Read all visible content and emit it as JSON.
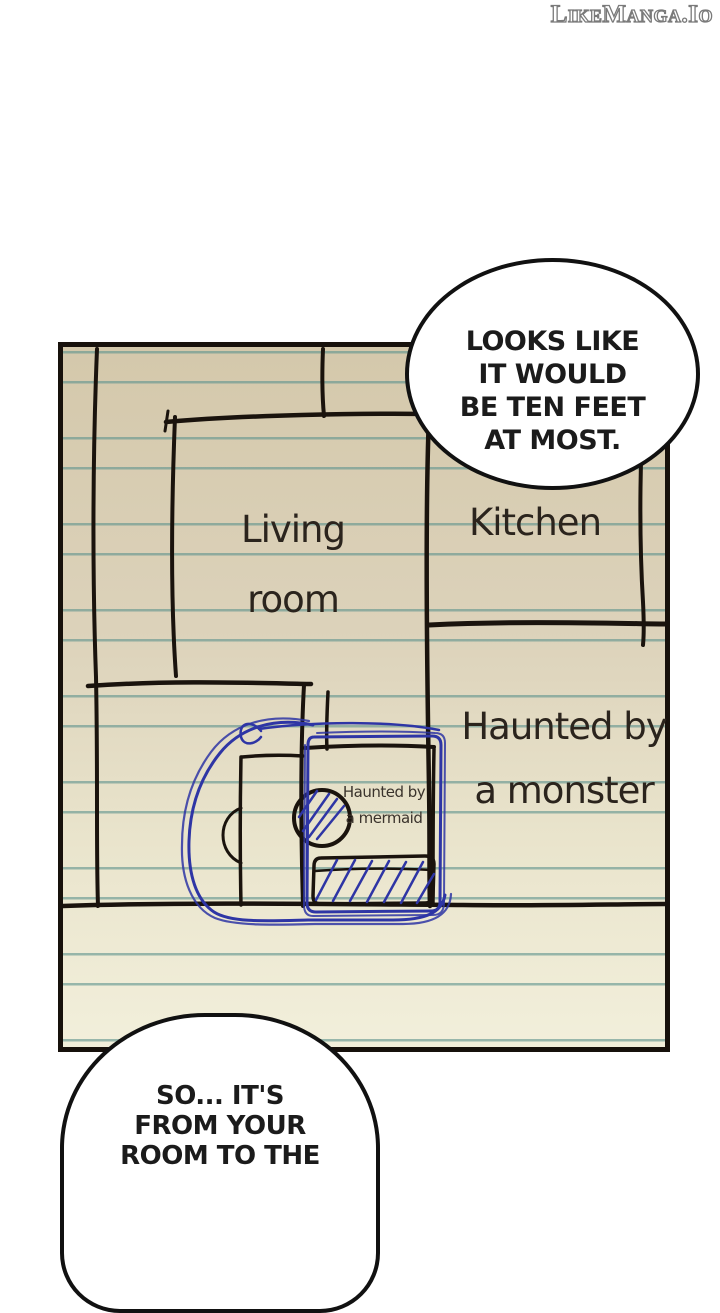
{
  "watermark": {
    "text": "LikeManga.Io"
  },
  "speech_bubbles": {
    "top": {
      "lines": [
        "LOOKS LIKE",
        "IT WOULD",
        "BE TEN FEET",
        "AT MOST."
      ]
    },
    "bottom": {
      "lines": [
        "SO... IT'S",
        "FROM YOUR",
        "ROOM TO THE"
      ]
    }
  },
  "floor_plan": {
    "labels": {
      "living_room_line1": "Living",
      "living_room_line2": "room",
      "kitchen": "Kitchen",
      "monster_line1": "Haunted by",
      "monster_line2": "a monster",
      "mermaid_line1": "Haunted by",
      "mermaid_line2": "a mermaid"
    },
    "colors": {
      "paper_top": "#d4c8ab",
      "paper_bottom": "#f2efdb",
      "ruled_line": "#60948e",
      "ink_black": "#1a130d",
      "pen_blue": "#2e35a5",
      "bubble_fill": "#ffffff",
      "bubble_border": "#111111"
    }
  }
}
